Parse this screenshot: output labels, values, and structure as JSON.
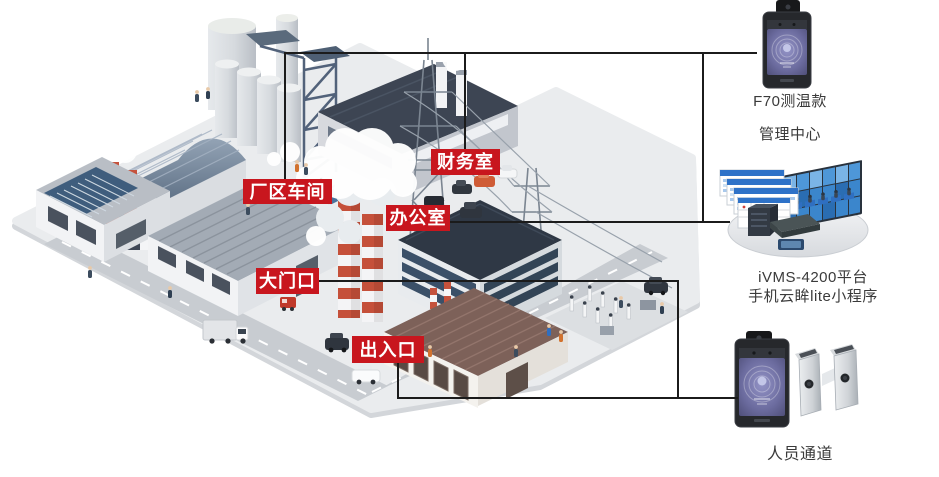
{
  "area_labels": {
    "workshop": "厂区车间",
    "finance": "财务室",
    "office": "办公室",
    "main_gate": "大门口",
    "entrance_exit": "出入口"
  },
  "right_panel": {
    "f70": {
      "line1": "F70测温款",
      "line2": "管理中心"
    },
    "platform": {
      "line1": "iVMS-4200平台",
      "line2": "手机云眸lite小程序"
    },
    "passage": {
      "line1": "人员通道"
    }
  },
  "colors": {
    "label_bg": "#C8161E",
    "label_text": "#FFFFFF",
    "caption_text": "#3A3A3A",
    "connector": "#1B1B1B",
    "screen_blue": "#3E8ED2",
    "chimney_red": "#C5503A"
  }
}
